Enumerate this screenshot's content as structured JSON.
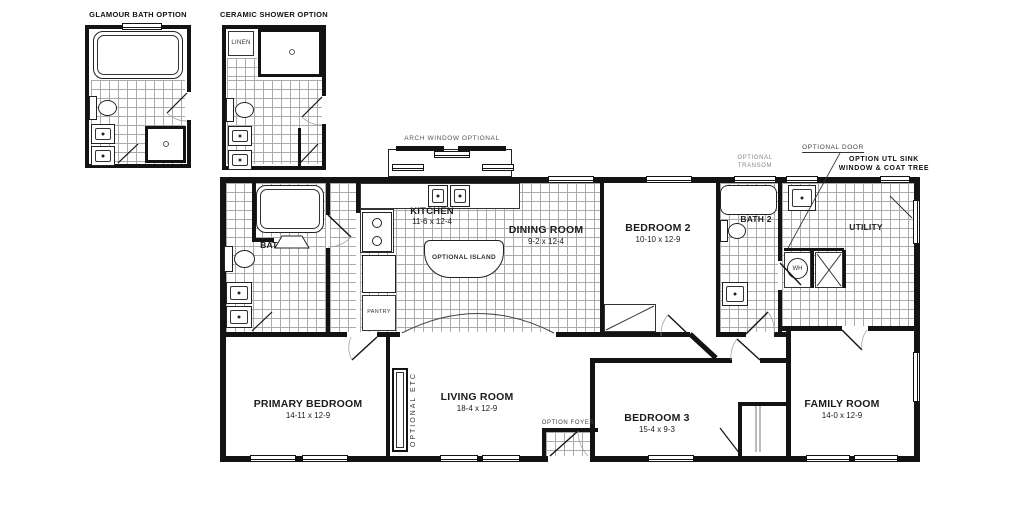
{
  "insets": {
    "glamour": {
      "title": "GLAMOUR BATH OPTION"
    },
    "ceramic": {
      "title": "CERAMIC SHOWER OPTION",
      "linen": "LINEN"
    }
  },
  "rooms": {
    "bath": {
      "name": "BATH"
    },
    "kitchen": {
      "name": "KITCHEN",
      "dims": "11-6 x 12-4"
    },
    "dining": {
      "name": "DINING ROOM",
      "dims": "9-2 x 12-4"
    },
    "bedroom2": {
      "name": "BEDROOM 2",
      "dims": "10-10 x 12-9"
    },
    "bath2": {
      "name": "BATH 2"
    },
    "utility": {
      "name": "UTILITY"
    },
    "primary": {
      "name": "PRIMARY BEDROOM",
      "dims": "14-11 x 12-9"
    },
    "living": {
      "name": "LIVING ROOM",
      "dims": "18-4 x 12-9"
    },
    "bedroom3": {
      "name": "BEDROOM 3",
      "dims": "15-4 x 9-3"
    },
    "family": {
      "name": "FAMILY ROOM",
      "dims": "14-0 x 12-9"
    }
  },
  "annotations": {
    "arch_window": "ARCH WINDOW OPTIONAL",
    "optional_door": "OPTIONAL DOOR",
    "optional_transom_1": "OPTIONAL",
    "optional_transom_2": "TRANSOM",
    "option_utl_1": "OPTION UTL SINK",
    "option_utl_2": "WINDOW & COAT TREE",
    "optional_etc": "OPTIONAL ETC",
    "option_foyer": "OPTION FOYER",
    "pantry": "PANTRY",
    "optional_island": "OPTIONAL ISLAND",
    "water_heater": "WH"
  },
  "colors": {
    "wall": "#131313",
    "tile_line": "#ababab",
    "text": "#1c1c1c",
    "note": "#444444"
  }
}
